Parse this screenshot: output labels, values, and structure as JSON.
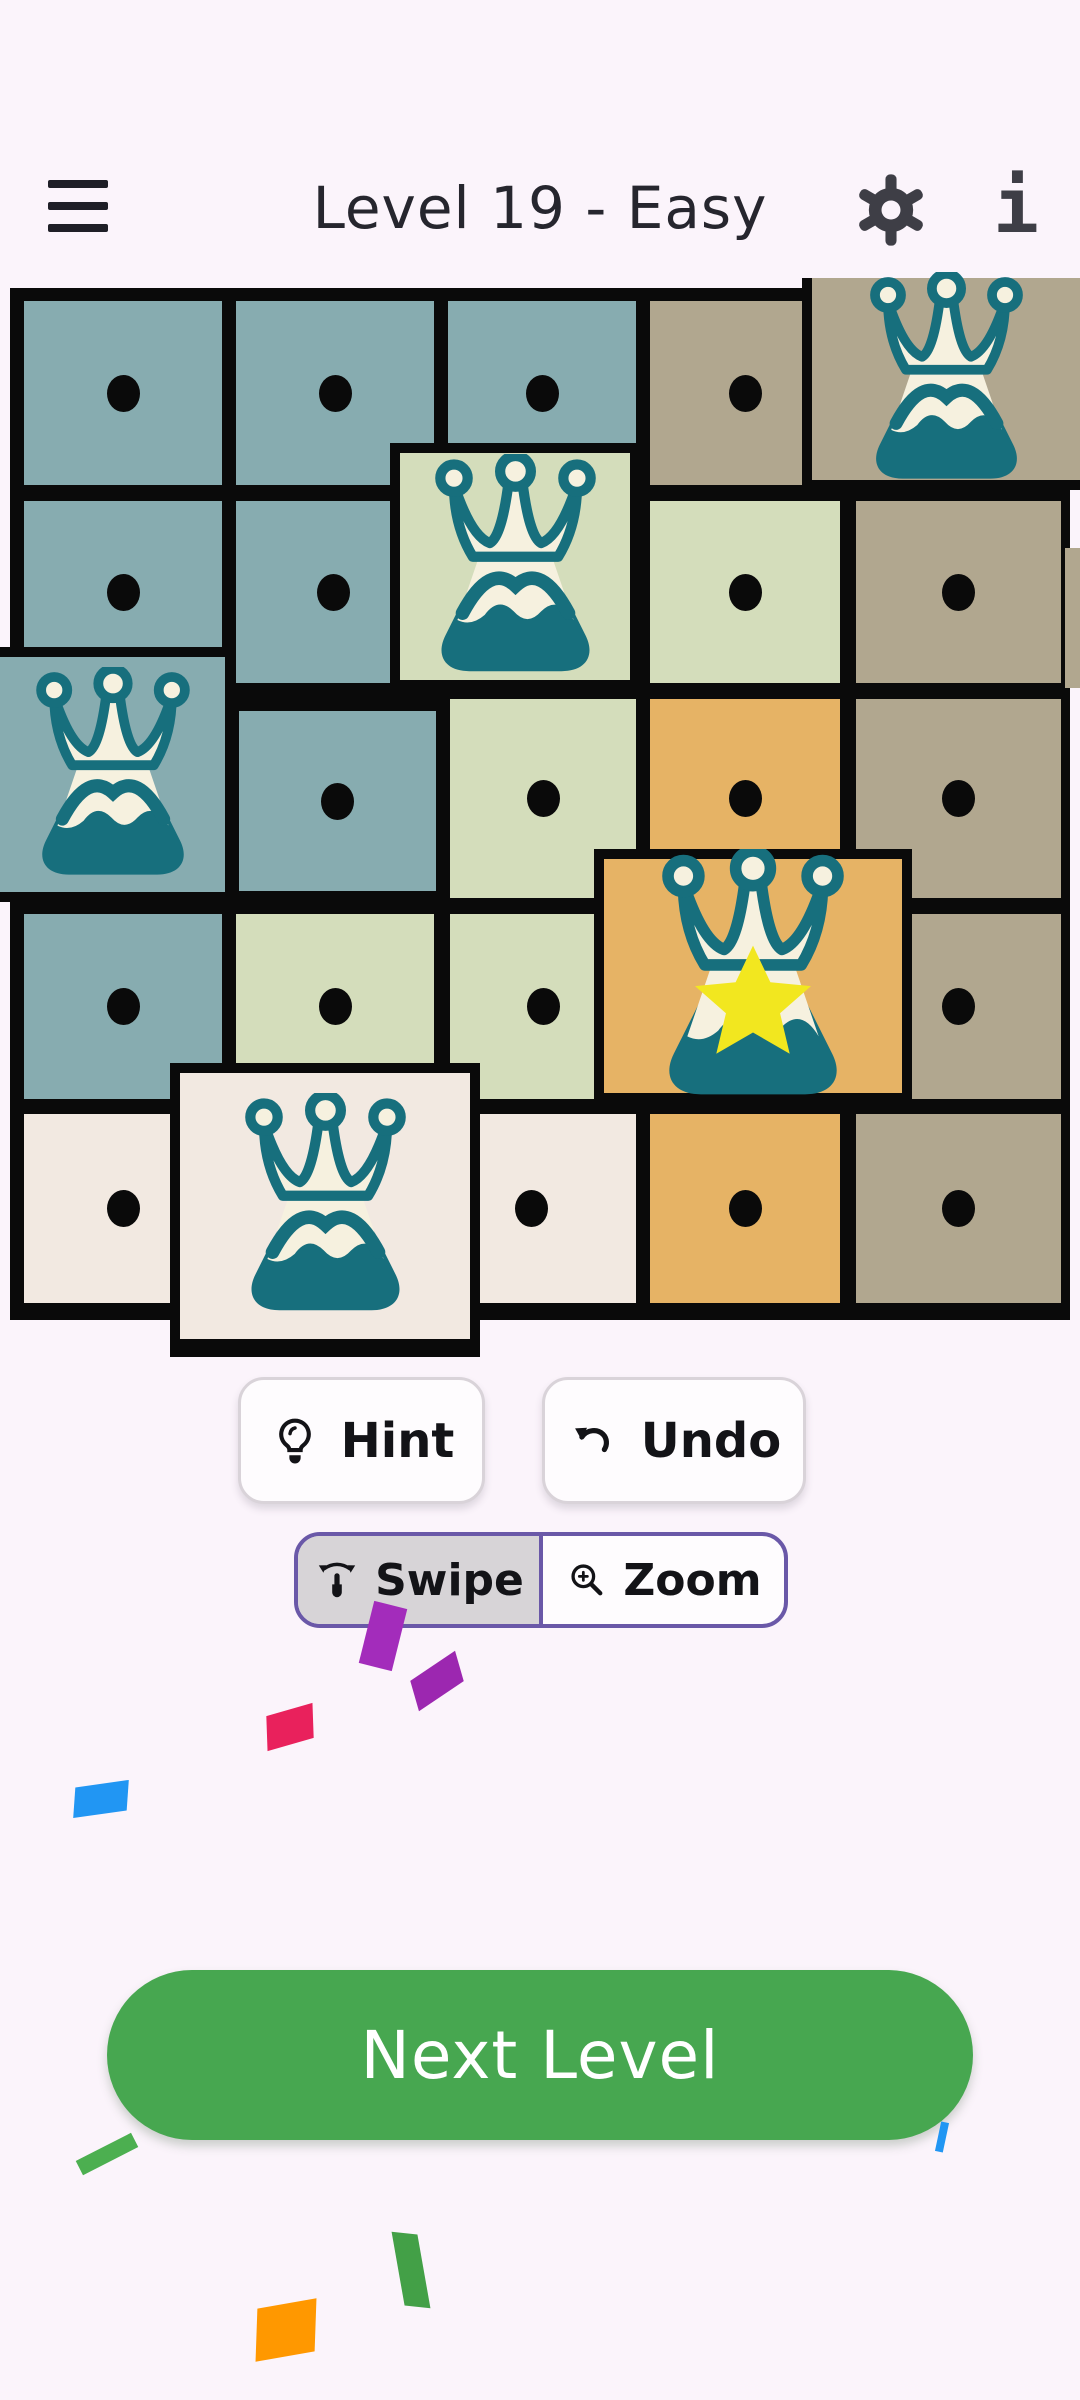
{
  "header": {
    "title": "Level 19 - Easy",
    "menu_icon": "hamburger",
    "settings_icon": "gear",
    "info_glyph": "i",
    "icon_color": "#3E3E46",
    "title_color": "#26262E"
  },
  "board": {
    "border_color": "#0A0A0A",
    "backdrop": {
      "x": 10,
      "y": 288,
      "w": 1060,
      "h": 1032
    },
    "palette": {
      "blue": "#87ACB0",
      "green": "#D4DDBB",
      "taupe": "#B1A78F",
      "orange": "#E6B365",
      "cream": "#F2E9E1"
    },
    "crown_colors": {
      "teal": "#176F7D",
      "cream": "#F6F1DF",
      "star": "#F2E71F"
    },
    "dot_color": "#0A0A0A",
    "cells": [
      {
        "r": 1,
        "c": 1,
        "color": "blue",
        "content": "dot",
        "x": 20,
        "y": 297,
        "w": 206,
        "h": 192
      },
      {
        "r": 1,
        "c": 2,
        "color": "blue",
        "content": "dot",
        "x": 232,
        "y": 297,
        "w": 206,
        "h": 192
      },
      {
        "r": 1,
        "c": 3,
        "color": "blue",
        "content": "dot",
        "x": 444,
        "y": 297,
        "w": 196,
        "h": 192
      },
      {
        "r": 1,
        "c": 4,
        "color": "taupe",
        "content": "dot",
        "x": 646,
        "y": 297,
        "w": 198,
        "h": 192
      },
      {
        "r": 2,
        "c": 1,
        "color": "blue",
        "content": "dot",
        "x": 20,
        "y": 497,
        "w": 206,
        "h": 190
      },
      {
        "r": 2,
        "c": 2,
        "color": "blue",
        "content": "dot",
        "x": 232,
        "y": 497,
        "w": 203,
        "h": 190
      },
      {
        "r": 2,
        "c": 4,
        "color": "green",
        "content": "dot",
        "x": 646,
        "y": 497,
        "w": 198,
        "h": 190
      },
      {
        "r": 2,
        "c": 5,
        "color": "taupe",
        "content": "dot",
        "x": 852,
        "y": 497,
        "w": 213,
        "h": 190
      },
      {
        "r": 2,
        "c": 5,
        "color": "taupe",
        "content": "",
        "x": 1065,
        "y": 548,
        "w": 15,
        "h": 140,
        "noborder": true
      },
      {
        "r": 3,
        "c": 2,
        "color": "blue",
        "content": "dot",
        "x": 235,
        "y": 707,
        "w": 205,
        "h": 188
      },
      {
        "r": 3,
        "c": 3,
        "color": "green",
        "content": "dot",
        "x": 446,
        "y": 695,
        "w": 194,
        "h": 207
      },
      {
        "r": 3,
        "c": 4,
        "color": "orange",
        "content": "dot",
        "x": 646,
        "y": 695,
        "w": 198,
        "h": 207
      },
      {
        "r": 3,
        "c": 5,
        "color": "taupe",
        "content": "dot",
        "x": 852,
        "y": 695,
        "w": 213,
        "h": 207
      },
      {
        "r": 4,
        "c": 1,
        "color": "blue",
        "content": "dot",
        "x": 20,
        "y": 910,
        "w": 206,
        "h": 193
      },
      {
        "r": 4,
        "c": 2,
        "color": "green",
        "content": "dot",
        "x": 232,
        "y": 910,
        "w": 206,
        "h": 193
      },
      {
        "r": 4,
        "c": 3,
        "color": "green",
        "content": "dot",
        "x": 446,
        "y": 910,
        "w": 194,
        "h": 193
      },
      {
        "r": 4,
        "c": 5,
        "color": "taupe",
        "content": "dot",
        "x": 852,
        "y": 910,
        "w": 213,
        "h": 193
      },
      {
        "r": 5,
        "c": 1,
        "color": "cream",
        "content": "dot",
        "x": 20,
        "y": 1110,
        "w": 207,
        "h": 197
      },
      {
        "r": 5,
        "c": 3,
        "color": "cream",
        "content": "dot",
        "x": 423,
        "y": 1110,
        "w": 217,
        "h": 197
      },
      {
        "r": 5,
        "c": 4,
        "color": "orange",
        "content": "dot",
        "x": 646,
        "y": 1110,
        "w": 198,
        "h": 197
      },
      {
        "r": 5,
        "c": 5,
        "color": "taupe",
        "content": "dot",
        "x": 852,
        "y": 1110,
        "w": 213,
        "h": 197
      },
      {
        "r": 1,
        "c": 5,
        "color": "taupe",
        "content": "crown",
        "x": 802,
        "y": 278,
        "w": 278,
        "h": 212,
        "bw": 10,
        "open": [
          "top",
          "right"
        ],
        "icon": 195
      },
      {
        "r": 2,
        "c": 3,
        "color": "green",
        "content": "crown",
        "x": 390,
        "y": 443,
        "w": 250,
        "h": 247,
        "bw": 10,
        "icon": 205
      },
      {
        "r": 3,
        "c": 1,
        "color": "blue",
        "content": "crown",
        "x": 0,
        "y": 647,
        "w": 235,
        "h": 255,
        "bw": 10,
        "open": [
          "left"
        ],
        "icon": 196
      },
      {
        "r": 4,
        "c": 4,
        "color": "orange",
        "content": "crown_star",
        "x": 594,
        "y": 849,
        "w": 318,
        "h": 254,
        "bw": 10,
        "icon": 232
      },
      {
        "r": 5,
        "c": 2,
        "color": "cream",
        "content": "crown",
        "x": 170,
        "y": 1063,
        "w": 310,
        "h": 294,
        "bw": 10,
        "bb": 18,
        "icon": 205
      }
    ]
  },
  "controls": {
    "hint": {
      "label": "Hint",
      "icon": "lightbulb-icon"
    },
    "undo": {
      "label": "Undo",
      "icon": "undo-arrow-icon"
    },
    "mode_toggle": {
      "accent": "#6A58A8",
      "selected_bg": "#D7D4D7",
      "options": [
        {
          "label": "Swipe",
          "icon": "swipe-gesture-icon",
          "selected": true
        },
        {
          "label": "Zoom",
          "icon": "magnifier-plus-icon",
          "selected": false
        }
      ]
    }
  },
  "next_level": {
    "label": "Next Level",
    "color": "#47A750"
  },
  "confetti": [
    {
      "x": 366,
      "y": 1604,
      "w": 34,
      "h": 64,
      "rot": 14,
      "skew": 0,
      "color": "#A32CBB"
    },
    {
      "x": 410,
      "y": 1666,
      "w": 54,
      "h": 30,
      "rot": -34,
      "skew": -18,
      "color": "#9C27B0"
    },
    {
      "x": 266,
      "y": 1710,
      "w": 48,
      "h": 34,
      "rot": -16,
      "skew": -14,
      "color": "#E9215C"
    },
    {
      "x": 74,
      "y": 1784,
      "w": 54,
      "h": 30,
      "rot": -8,
      "skew": -12,
      "color": "#2196F3"
    },
    {
      "x": 76,
      "y": 2146,
      "w": 62,
      "h": 16,
      "rot": -27,
      "skew": 0,
      "color": "#4CAF50"
    },
    {
      "x": 398,
      "y": 2234,
      "w": 26,
      "h": 72,
      "rot": 6,
      "skew": 16,
      "color": "#43A047"
    },
    {
      "x": 256,
      "y": 2304,
      "w": 60,
      "h": 52,
      "rot": -10,
      "skew": -12,
      "color": "#FF9800"
    },
    {
      "x": 938,
      "y": 2122,
      "w": 8,
      "h": 30,
      "rot": 12,
      "skew": 0,
      "color": "#2196F3"
    }
  ]
}
